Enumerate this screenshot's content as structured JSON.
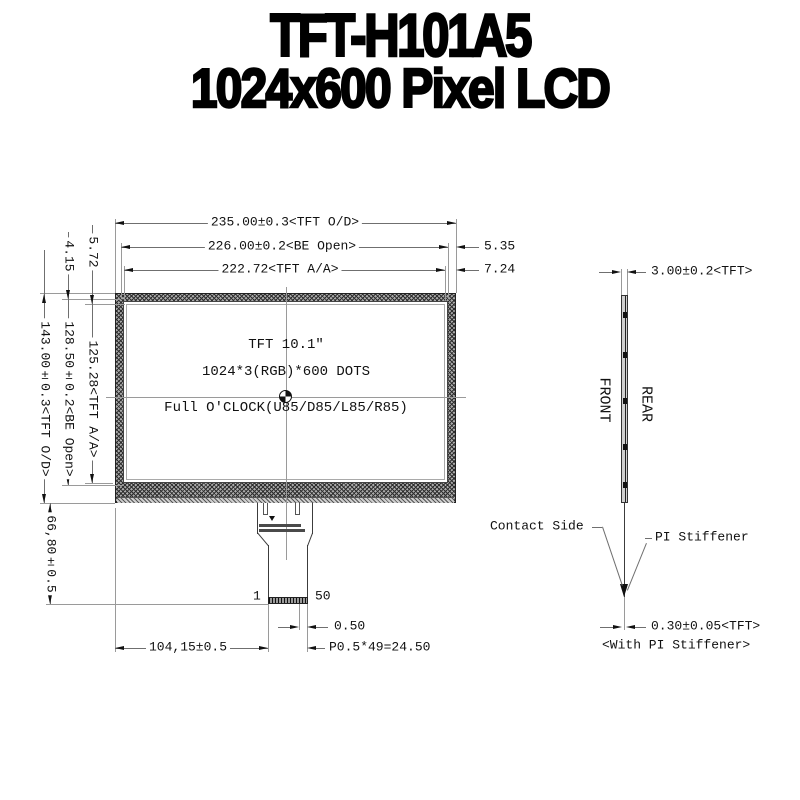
{
  "title": {
    "line1": "TFT-H101A5",
    "line2": "1024x600 Pixel LCD"
  },
  "front_view": {
    "dim_width_od": "235.00±0.3<TFT O/D>",
    "dim_width_be": "226.00±0.2<BE Open>",
    "dim_width_aa": "222.72<TFT A/A>",
    "dim_right_be_offset": "5.35",
    "dim_right_aa_offset": "7.24",
    "dim_top_be_offset": "4.15",
    "dim_top_aa_offset": "5.72",
    "dim_height_od": "143.00±0.3<TFT O/D>",
    "dim_height_be": "128.50±0.2<BE Open>",
    "dim_height_aa": "125.28<TFT A/A>",
    "dim_fpc_length": "66,80±0.5",
    "panel_text": {
      "line1": "TFT 10.1″",
      "line2": "1024*3(RGB)*600 DOTS",
      "line3": "Full O'CLOCK(U85/D85/L85/R85)"
    },
    "fpc": {
      "pin_first": "1",
      "pin_last": "50",
      "dim_pitch_edge": "0.50",
      "dim_tail_offset": "104,15±0.5",
      "dim_pitch_total": "P0.5*49=24.50"
    }
  },
  "side_view": {
    "dim_thickness": "3.00±0.2<TFT>",
    "label_front": "FRONT",
    "label_rear": "REAR",
    "label_contact": "Contact Side",
    "label_stiffener": "PI Stiffener",
    "dim_fpc_thickness": "0.30±0.05<TFT>",
    "note_stiffener": "<With PI Stiffener>"
  },
  "colors": {
    "ink": "#111111",
    "thin_line": "#6f6f6f",
    "hatch": "#ababab"
  }
}
